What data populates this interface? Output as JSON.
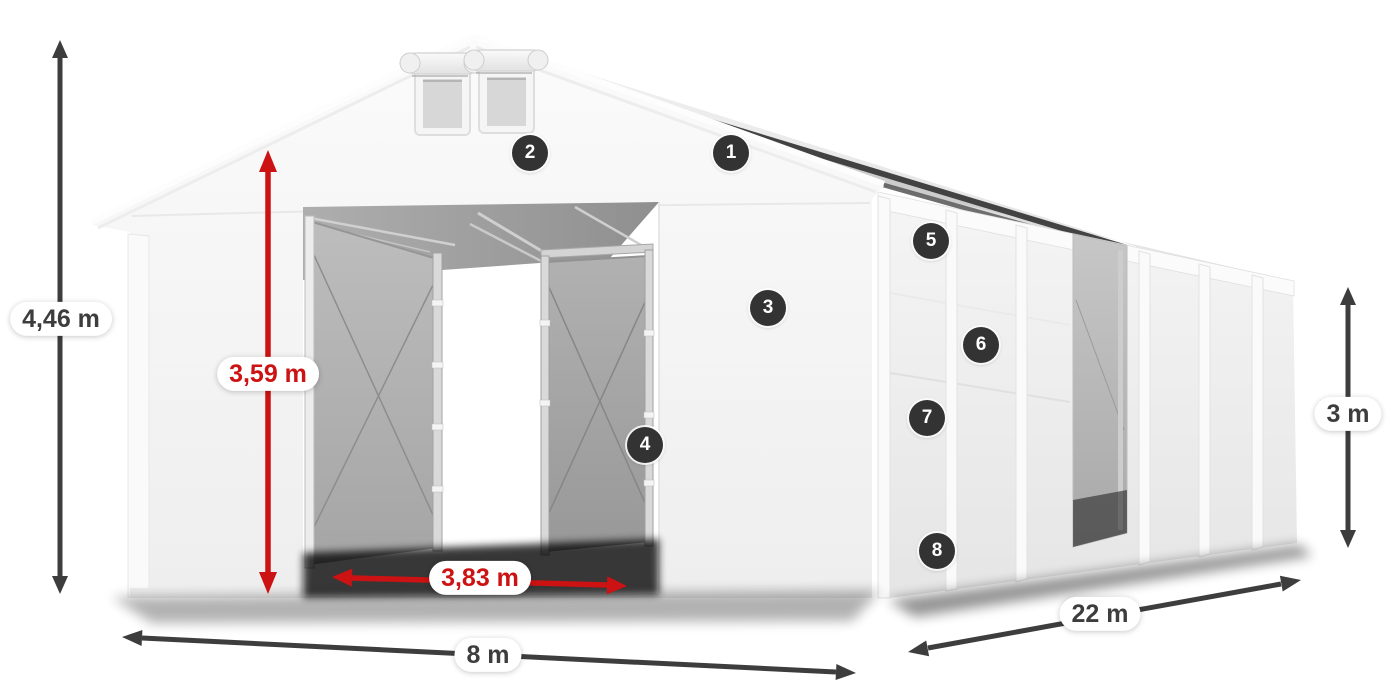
{
  "diagram": {
    "dimensions": {
      "total_height": "4,46 m",
      "door_height": "3,59 m",
      "door_width": "3,83 m",
      "width": "8 m",
      "length": "22 m",
      "wall_height": "3 m"
    },
    "markers": [
      "1",
      "2",
      "3",
      "4",
      "5",
      "6",
      "7",
      "8"
    ],
    "colors": {
      "arrow_dark": "#3d3d3d",
      "arrow_red": "#cc1212",
      "marker_background": "#333333",
      "marker_text": "#ffffff",
      "label_background": "#ffffff",
      "label_text_dark": "#3d3d3d",
      "label_text_red": "#cc1212"
    }
  }
}
